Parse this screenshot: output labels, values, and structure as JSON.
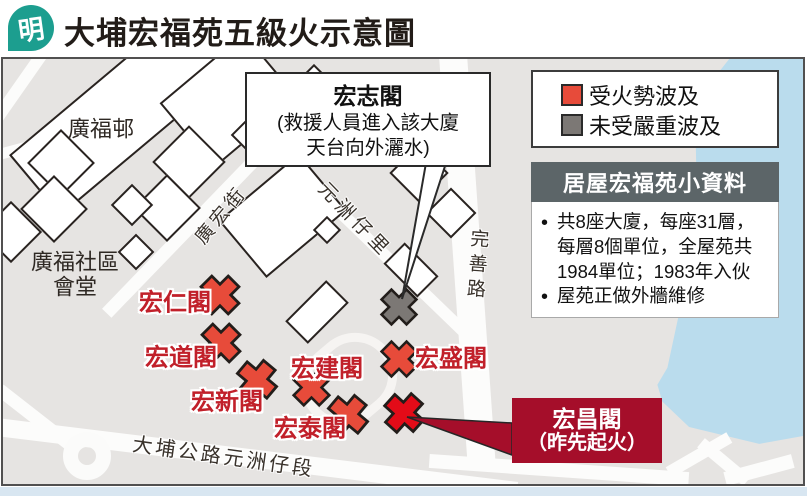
{
  "header": {
    "logo_char": "明",
    "logo_color": "#1c9e8f",
    "title": "大埔宏福苑五級火示意圖"
  },
  "legend": {
    "items": [
      {
        "label": "受火勢波及",
        "color": "#e74b3a"
      },
      {
        "label": "未受嚴重波及",
        "color": "#7c7875"
      }
    ]
  },
  "info_box": {
    "header_bg": "#5c6568",
    "title": "居屋宏福苑小資料",
    "bullets": [
      "共8座大廈，每座31層，每層8個單位，全屋苑共1984單位；1983年入伙",
      "屋苑正做外牆維修"
    ]
  },
  "callouts": {
    "hong_chi": {
      "title": "宏志閣",
      "body": "(救援人員進入該大廈\n天台向外灑水)"
    },
    "hong_cheong": {
      "line1": "宏昌閣",
      "line2": "（昨先起火）",
      "bg": "#a50e2a"
    }
  },
  "map": {
    "colors": {
      "fire": "#e74b3a",
      "origin": "#e30b18",
      "spared": "#7c7875",
      "label_red": "#c1202a",
      "water": "#badced",
      "bg": "#e6e4e2"
    },
    "buildings": [
      {
        "id": "hong-yan-kok",
        "type": "fire",
        "x": 217,
        "y": 236,
        "size": 50,
        "rot": 45
      },
      {
        "id": "hong-to-kok",
        "type": "fire",
        "x": 218,
        "y": 284,
        "size": 50,
        "rot": 45
      },
      {
        "id": "hong-sun-kok",
        "type": "fire",
        "x": 254,
        "y": 321,
        "size": 50,
        "rot": 40
      },
      {
        "id": "hong-kin-kok",
        "type": "fire",
        "x": 308,
        "y": 328,
        "size": 47,
        "rot": 45
      },
      {
        "id": "hong-tai-kok",
        "type": "fire",
        "x": 345,
        "y": 356,
        "size": 50,
        "rot": 40
      },
      {
        "id": "hong-shing-kok",
        "type": "fire",
        "x": 396,
        "y": 300,
        "size": 46,
        "rot": 45
      },
      {
        "id": "hong-cheong-kok",
        "type": "origin",
        "x": 401,
        "y": 354,
        "size": 50,
        "rot": 42
      },
      {
        "id": "hong-chi-kok",
        "type": "spared",
        "x": 396,
        "y": 248,
        "size": 46,
        "rot": 45
      }
    ],
    "building_labels": [
      {
        "text": "宏仁閣",
        "x": 172,
        "y": 241
      },
      {
        "text": "宏道閣",
        "x": 178,
        "y": 296
      },
      {
        "text": "宏新閣",
        "x": 224,
        "y": 340
      },
      {
        "text": "宏建閣",
        "x": 324,
        "y": 307
      },
      {
        "text": "宏泰閣",
        "x": 307,
        "y": 367
      },
      {
        "text": "宏盛閣",
        "x": 448,
        "y": 297
      }
    ],
    "street_labels": [
      {
        "text": "廣宏街",
        "x": 217,
        "y": 155,
        "rot": -50,
        "size": 19,
        "spacing": 4,
        "vertical": false
      },
      {
        "text": "元洲仔里",
        "x": 353,
        "y": 160,
        "rot": 46,
        "size": 19,
        "spacing": 5,
        "vertical": false
      },
      {
        "text": "完善路",
        "x": 473,
        "y": 207,
        "rot": 4,
        "size": 19,
        "spacing": 6,
        "vertical": true
      },
      {
        "text": "大埔公路元洲仔段",
        "x": 221,
        "y": 396,
        "rot": 8,
        "size": 20,
        "spacing": 3,
        "vertical": false
      }
    ],
    "area_labels": [
      {
        "text": "廣福邨",
        "x": 98,
        "y": 70,
        "size": 22
      },
      {
        "text": "廣福社區\n會堂",
        "x": 72,
        "y": 216,
        "size": 22
      }
    ]
  }
}
